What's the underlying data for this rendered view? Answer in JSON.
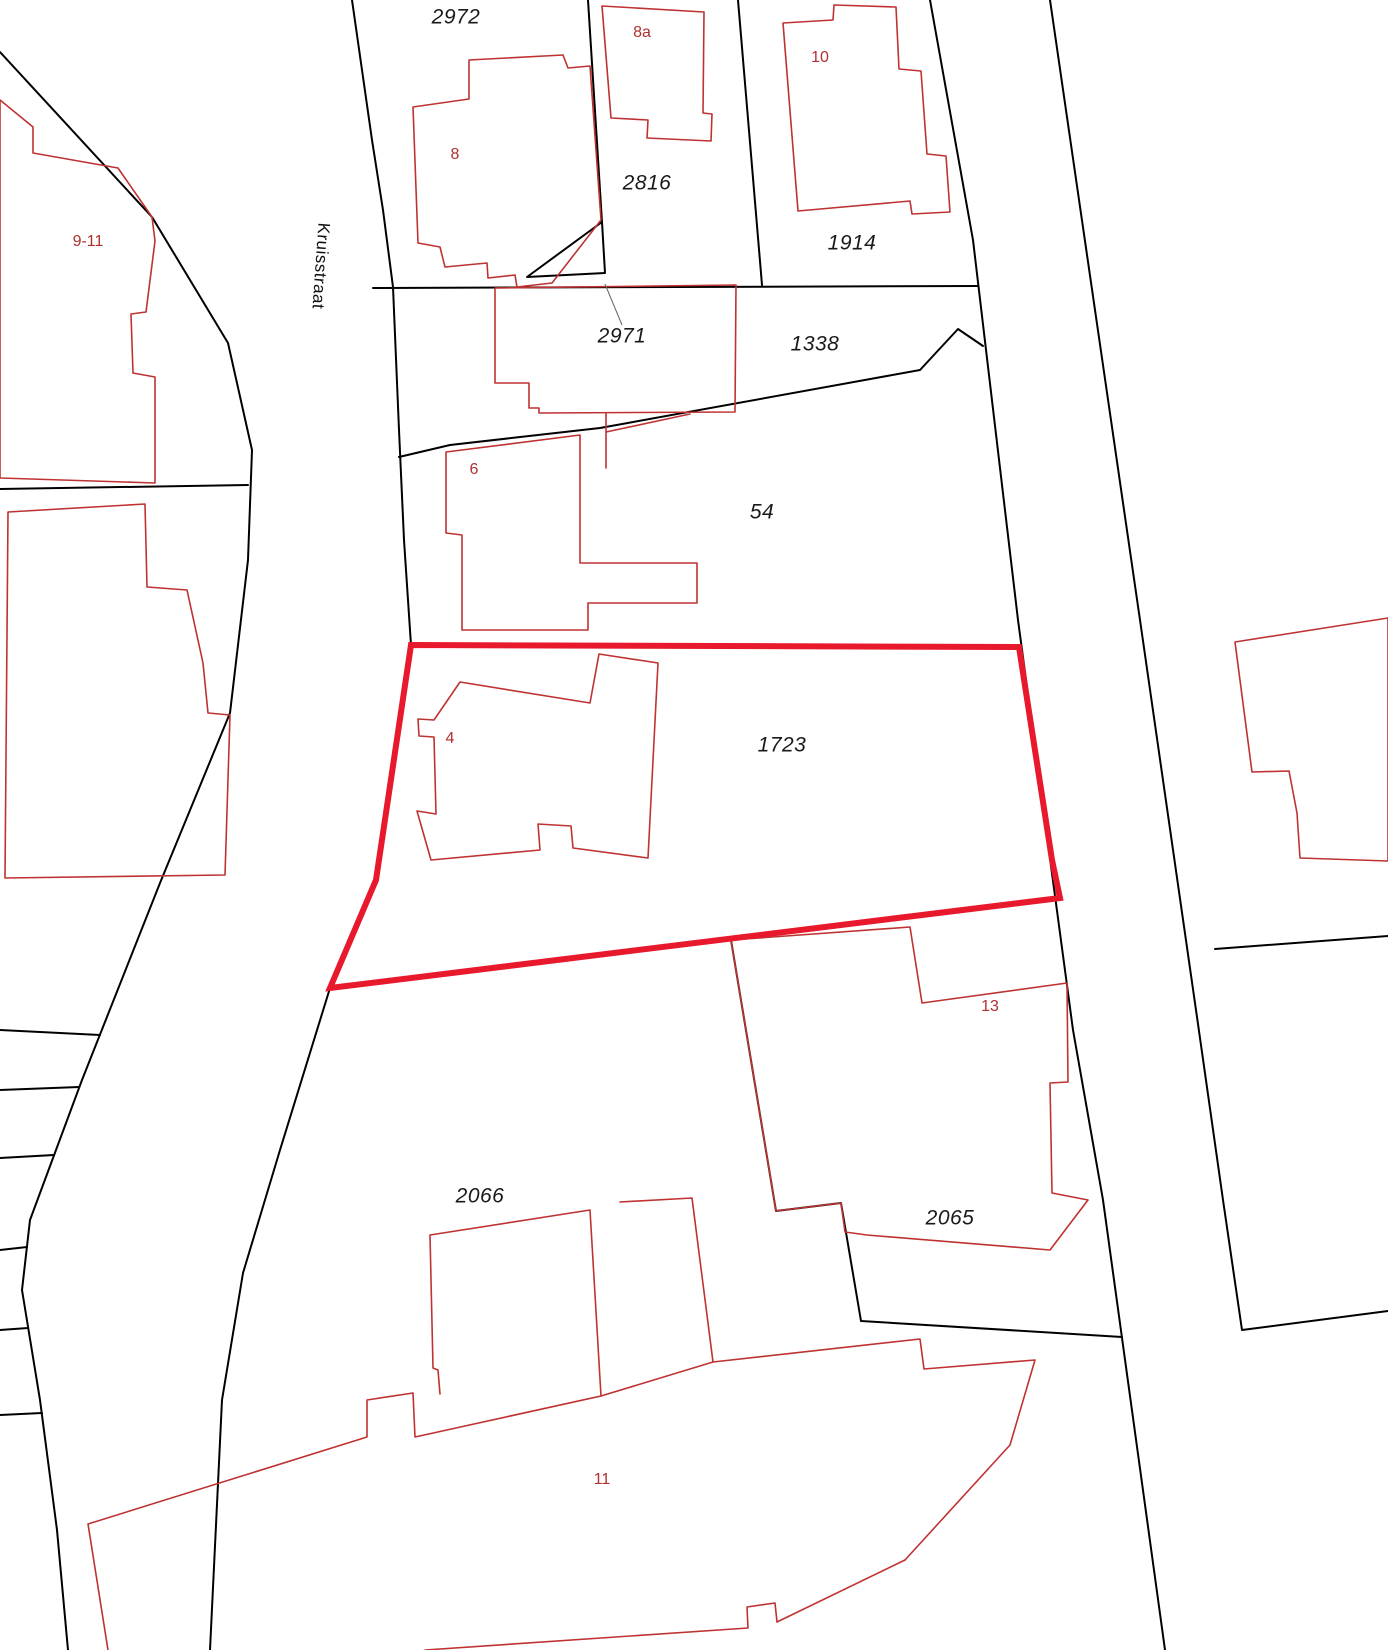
{
  "map": {
    "title": "Kadastrale kaart (cadastral parcel map)",
    "street_label": {
      "text": "Kruisstraat",
      "x": 321,
      "y": 266,
      "rotation_deg": 94
    },
    "highlight": {
      "parcel": "1723",
      "color": "#e8192c",
      "stroke_width": 6
    },
    "colors": {
      "background": "#ffffff",
      "parcel_line": "#000000",
      "building_line": "#bf3232",
      "building_label": "#b03030",
      "parcel_label": "#1a1a1a",
      "leader_line": "#666666"
    },
    "parcel_labels": [
      {
        "text": "2972",
        "x": 456,
        "y": 17
      },
      {
        "text": "2816",
        "x": 647,
        "y": 183
      },
      {
        "text": "1914",
        "x": 852,
        "y": 243
      },
      {
        "text": "2971",
        "x": 622,
        "y": 336
      },
      {
        "text": "1338",
        "x": 815,
        "y": 344
      },
      {
        "text": "54",
        "x": 762,
        "y": 512
      },
      {
        "text": "1723",
        "x": 782,
        "y": 745
      },
      {
        "text": "2066",
        "x": 480,
        "y": 1196
      },
      {
        "text": "2065",
        "x": 950,
        "y": 1218
      }
    ],
    "building_labels": [
      {
        "text": "9-11",
        "x": 88,
        "y": 242
      },
      {
        "text": "8",
        "x": 455,
        "y": 155
      },
      {
        "text": "8a",
        "x": 642,
        "y": 33
      },
      {
        "text": "10",
        "x": 820,
        "y": 58
      },
      {
        "text": "6",
        "x": 474,
        "y": 470
      },
      {
        "text": "4",
        "x": 450,
        "y": 739
      },
      {
        "text": "13",
        "x": 990,
        "y": 1007
      },
      {
        "text": "11",
        "x": 602,
        "y": 1480
      }
    ]
  }
}
